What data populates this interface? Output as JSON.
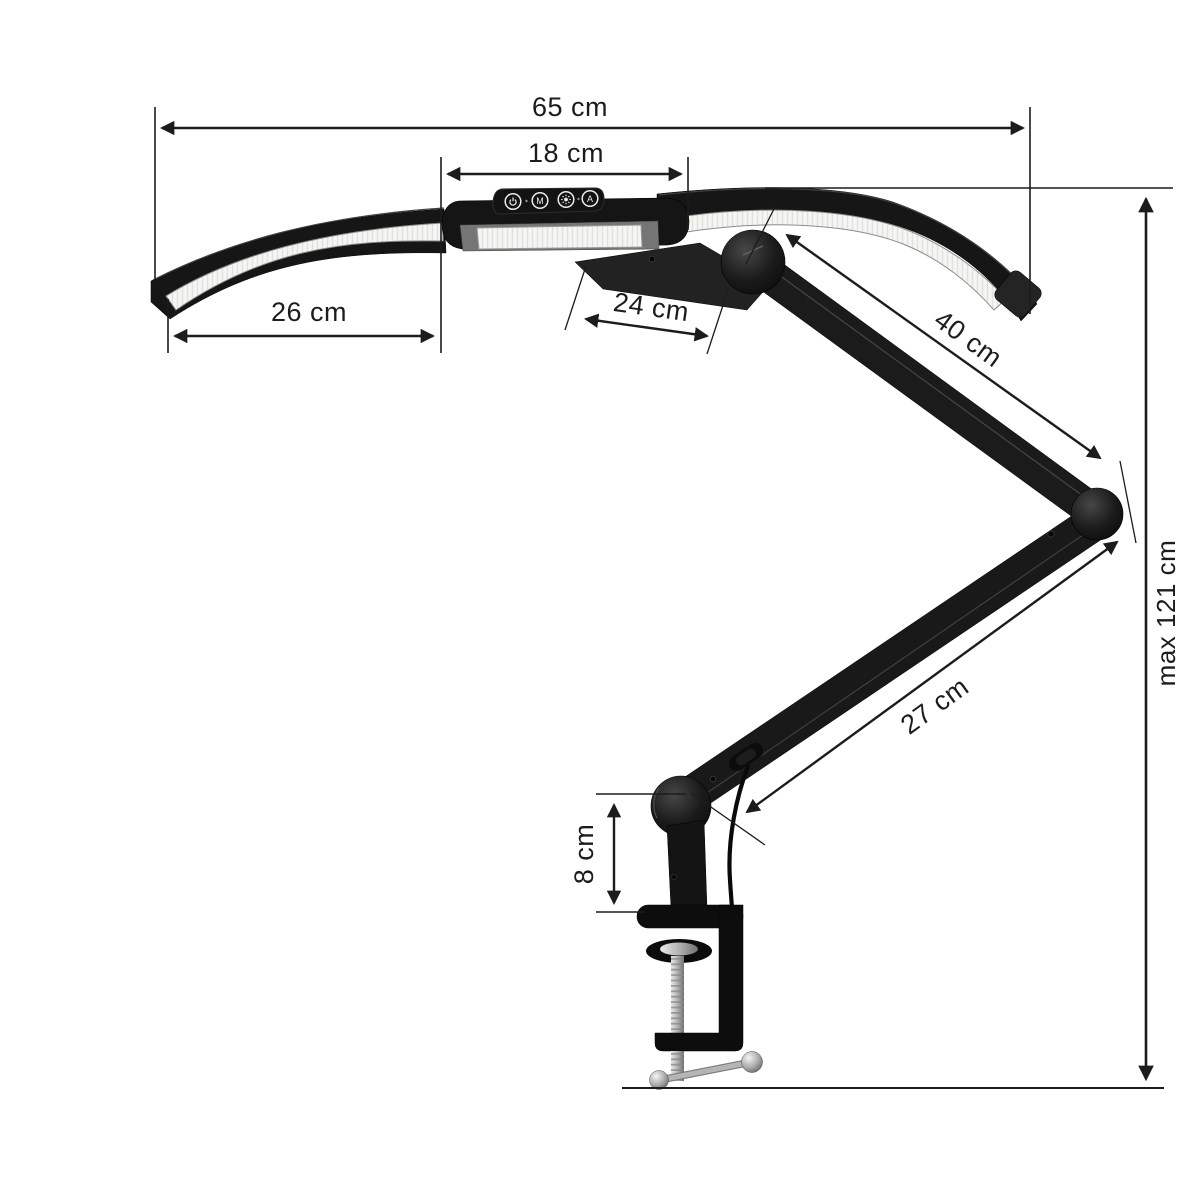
{
  "diagram": {
    "type": "product-dimension-diagram",
    "product": "dual-arm LED desk lamp with articulated arm and table clamp",
    "background": "#ffffff",
    "labels": {
      "total_width": "65 cm",
      "head_width": "18 cm",
      "left_panel_length": "26 cm",
      "head_bracket_depth": "24 cm",
      "upper_arm_length": "40 cm",
      "lower_arm_length": "27 cm",
      "clamp_mount_height": "8 cm",
      "max_height": "max 121 cm"
    },
    "control_panel": {
      "mode_label": "M",
      "auto_label": "A",
      "buttons": [
        "power-icon",
        "mode-button-M",
        "brightness-sun-icon",
        "auto-button-A"
      ]
    },
    "colors": {
      "annotation": "#1c1c1c",
      "lamp_body": "#161616",
      "led_strip": "#f4f4f2",
      "metal_silver": "#b9b9b9"
    }
  }
}
